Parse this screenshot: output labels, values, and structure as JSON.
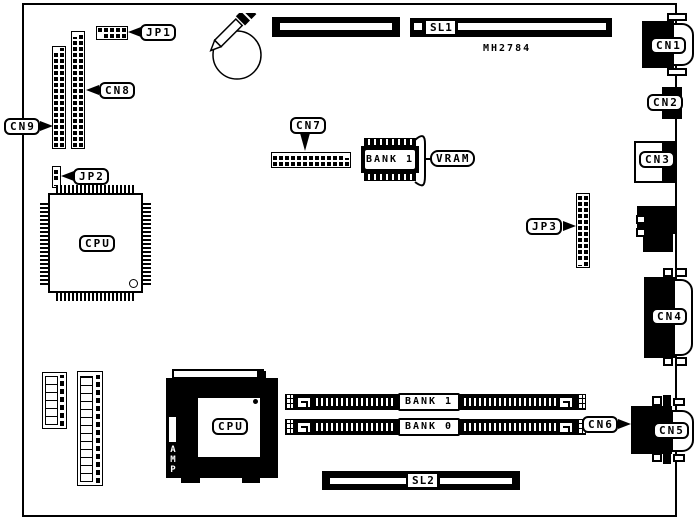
{
  "board": {
    "part_number": "MH2784",
    "colors": {
      "ink": "#000000",
      "background": "#ffffff"
    }
  },
  "labels": {
    "jp1": "JP1",
    "jp2": "JP2",
    "jp3": "JP3",
    "cn1": "CN1",
    "cn2": "CN2",
    "cn3": "CN3",
    "cn4": "CN4",
    "cn5": "CN5",
    "cn6": "CN6",
    "cn7": "CN7",
    "cn8": "CN8",
    "cn9": "CN9",
    "cpu_qfp": "CPU",
    "cpu_pga": "CPU",
    "sl1": "SL1",
    "sl2": "SL2",
    "vram": "VRAM",
    "vram_bank": "BANK 1",
    "bank1": "BANK 1",
    "bank0": "BANK 0",
    "amp": "AMP"
  }
}
